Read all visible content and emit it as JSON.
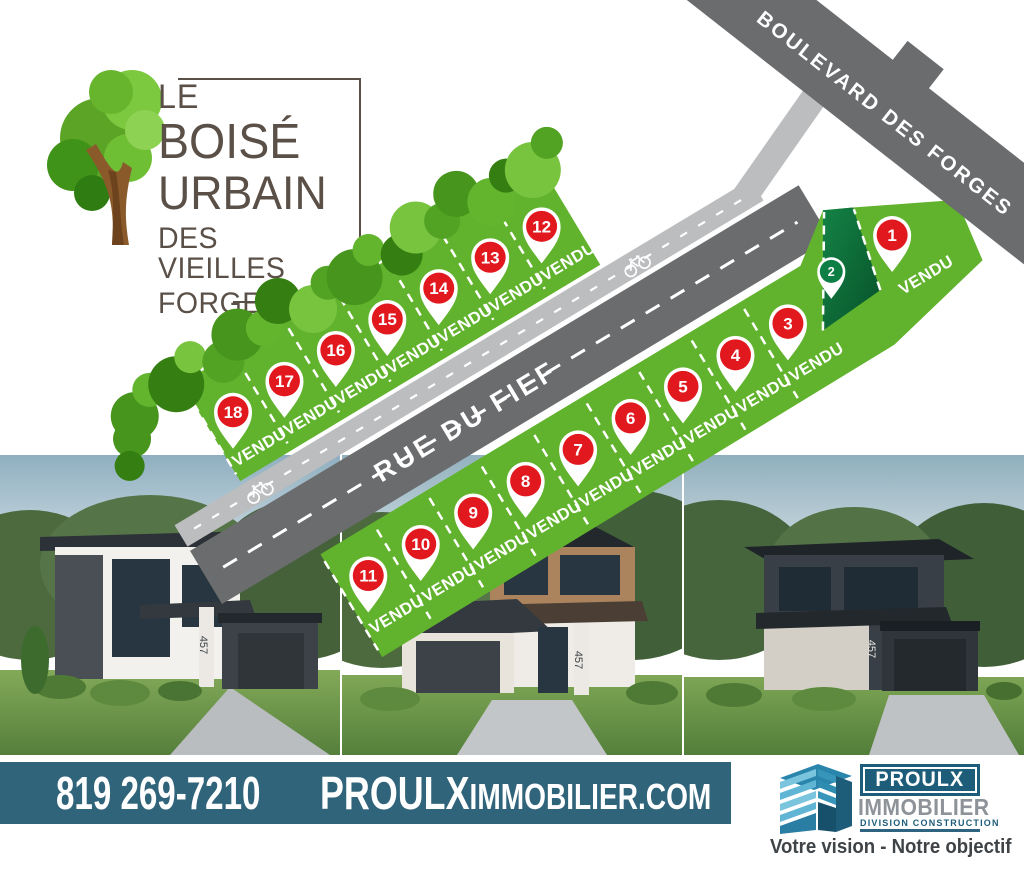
{
  "branding": {
    "line1": "LE",
    "line2": "BOISÉ",
    "line3": "URBAIN",
    "line4": "DES VIEILLES",
    "line5": "FORGES"
  },
  "map": {
    "boulevard_label": "BOULEVARD DES FORGES",
    "street_label": "RUE DU FIEF",
    "sold_label": "VENDU",
    "lots": [
      {
        "number": 1,
        "sold": true
      },
      {
        "number": 2,
        "sold": false
      },
      {
        "number": 3,
        "sold": true
      },
      {
        "number": 4,
        "sold": true
      },
      {
        "number": 5,
        "sold": true
      },
      {
        "number": 6,
        "sold": true
      },
      {
        "number": 7,
        "sold": true
      },
      {
        "number": 8,
        "sold": true
      },
      {
        "number": 9,
        "sold": true
      },
      {
        "number": 10,
        "sold": true
      },
      {
        "number": 11,
        "sold": true
      },
      {
        "number": 12,
        "sold": true
      },
      {
        "number": 13,
        "sold": true
      },
      {
        "number": 14,
        "sold": true
      },
      {
        "number": 15,
        "sold": true
      },
      {
        "number": 16,
        "sold": true
      },
      {
        "number": 17,
        "sold": true
      },
      {
        "number": 18,
        "sold": true
      }
    ],
    "colors": {
      "lot_green": "#61b32d",
      "lot_reserved_light": "#17934e",
      "lot_reserved_dark": "#0a5c30",
      "pin_red": "#e2181f",
      "road_gray": "#6b6c6e",
      "bike_path_gray": "#bcbdbf"
    }
  },
  "houses": {
    "number": "457"
  },
  "footer": {
    "phone": "819 269-7210",
    "website_main": "PROULX",
    "website_rest": "IMMOBILIER.COM",
    "bar_color": "#30647b"
  },
  "company": {
    "name": "PROULX",
    "sector": "IMMOBILIER",
    "division": "DIVISION  CONSTRUCTION",
    "tagline": "Votre vision - Notre objectif",
    "brand_color": "#1e5d79"
  }
}
